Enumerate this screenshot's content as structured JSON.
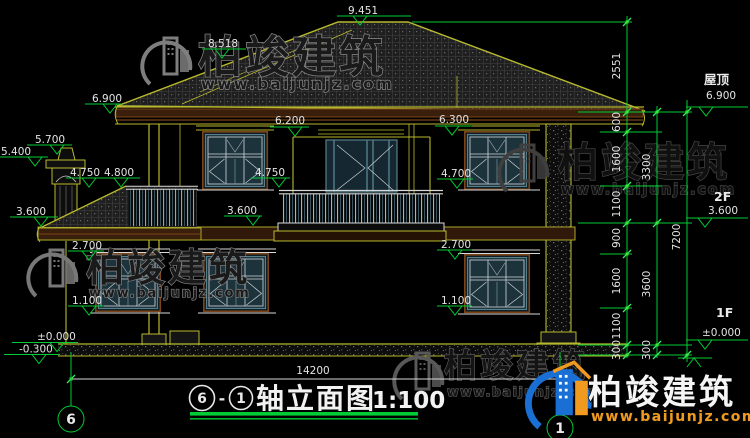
{
  "levels": [
    "9.451",
    "8.518",
    "6.900",
    "5.700",
    "5.400",
    "4.750",
    "4.800",
    "3.600",
    "6.200",
    "6.300",
    "4.750",
    "4.700",
    "3.600",
    "2.700",
    "2.700",
    "1.100",
    "1.100",
    "±0.000",
    "-0.300"
  ],
  "floors": {
    "roof_label": "屋顶",
    "roof_value": "6.900",
    "f2_label": "2F",
    "f2_value": "3.600",
    "f1_label": "1F",
    "f1_value": "±0.000"
  },
  "dims": {
    "inner": [
      "2551",
      "600",
      "1600",
      "1100",
      "900",
      "1600",
      "1100",
      "300"
    ],
    "middle": [
      "3300",
      "3600",
      "300"
    ],
    "outer": [
      "7200"
    ],
    "width": "14200"
  },
  "axes": {
    "left": "6",
    "right": "1"
  },
  "title": {
    "c1": "6",
    "sep": "-",
    "c2": "1",
    "name": "轴立面图",
    "scale": "1:100"
  },
  "wm": {
    "brand": "柏竣建筑",
    "url": "www.baijunjz.com"
  },
  "colors": {
    "annotation_green": "#00cc33",
    "cad_yellow": "#b9b92e",
    "dim_text": "#e3e3e3",
    "window_teal": "#567f8c",
    "frame_brown": "#7a4318",
    "logo_blue": "#1a6fd4",
    "logo_orange": "#f09a20"
  }
}
